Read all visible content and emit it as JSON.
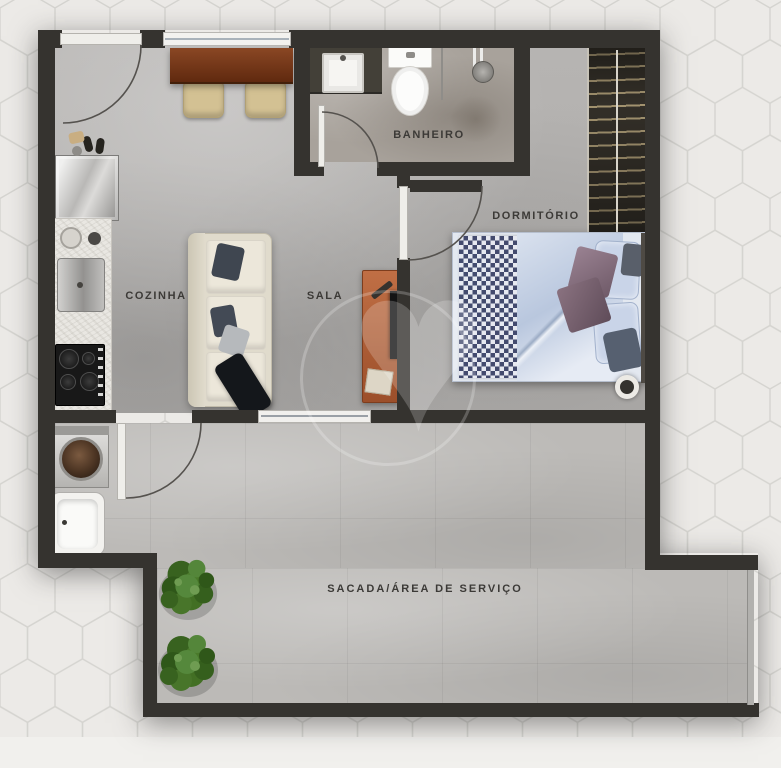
{
  "title": "apartment-floor-plan",
  "rooms": [
    {
      "id": "cozinha",
      "label": "COZINHA"
    },
    {
      "id": "sala",
      "label": "SALA"
    },
    {
      "id": "banheiro",
      "label": "BANHEIRO"
    },
    {
      "id": "dormitorio",
      "label": "DORMITÓRIO"
    },
    {
      "id": "sacada",
      "label": "SACADA/ÁREA DE SERVIÇO"
    }
  ],
  "watermark": {
    "glyph": "♥"
  },
  "colors": {
    "background_tile": "#eceae7",
    "tile_line": "#d5d4d0",
    "wall": "#35332f",
    "floor_main": "#b2b0ae",
    "floor_bathroom": "#a8a29b",
    "floor_balcony": "#bcbab7",
    "table_wood": "#7c3a1c",
    "tv_rack": "#b06039",
    "bed_linen": "#c6d2e4",
    "checker_navy": "#434a6e",
    "sofa_cream": "#e0dbcc",
    "plant_green": "#3c6b2d"
  },
  "furniture": [
    "dining-table",
    "dining-chair",
    "kitchen-sink",
    "kitchen-counter",
    "refrigerator",
    "cooktop",
    "sofa",
    "tv-rack",
    "bathroom-sink",
    "toilet",
    "shower",
    "wardrobe",
    "double-bed",
    "bedside-lamp",
    "washing-machine",
    "laundry-tub",
    "plant",
    "entry-shoes",
    "entry-door",
    "sliding-door"
  ]
}
